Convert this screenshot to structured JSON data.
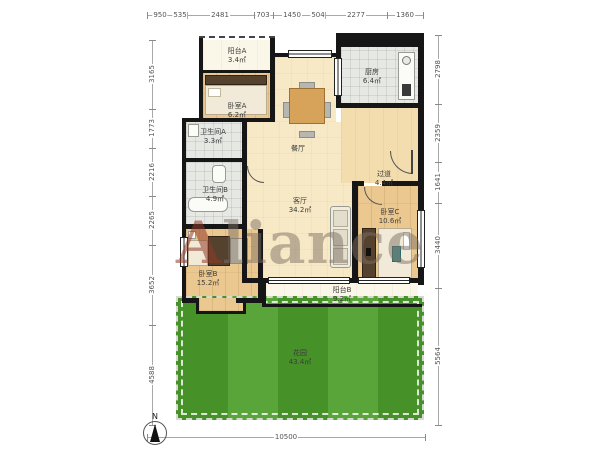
{
  "watermark": {
    "initial": "A",
    "rest": "liance"
  },
  "compass": {
    "north_label": "N"
  },
  "rooms": {
    "balcony_a": {
      "name": "阳台A",
      "area": "3.4㎡"
    },
    "bedroom_a": {
      "name": "卧室A",
      "area": "6.2㎡"
    },
    "bathroom_a": {
      "name": "卫生间A",
      "area": "3.3㎡"
    },
    "kitchen": {
      "name": "厨房",
      "area": "6.4㎡"
    },
    "dining": {
      "name": "餐厅"
    },
    "hallway": {
      "name": "过道",
      "area": "4.4㎡"
    },
    "living": {
      "name": "客厅",
      "area": "34.2㎡"
    },
    "bedroom_c": {
      "name": "卧室C",
      "area": "10.6㎡"
    },
    "bathroom_b": {
      "name": "卫生间B",
      "area": "4.9㎡"
    },
    "bedroom_b": {
      "name": "卧室B",
      "area": "15.2㎡"
    },
    "balcony_b": {
      "name": "阳台B",
      "area": "9.2㎡"
    },
    "garden": {
      "name": "花园",
      "area": "43.4㎡"
    }
  },
  "dimensions": {
    "top": [
      "950",
      "535",
      "2481",
      "703",
      "1450",
      "504",
      "2277",
      "1360"
    ],
    "left": [
      "3165",
      "1773",
      "2216",
      "2265",
      "3652",
      "4588"
    ],
    "right": [
      "2798",
      "2359",
      "1641",
      "3440",
      "5564"
    ],
    "bottom": [
      "10500"
    ]
  },
  "colors": {
    "wall": "#161616",
    "wood_floor": "#eac88f",
    "living_floor": "#f8e9c6",
    "tile_floor": "#e6e8e4",
    "balcony_floor": "#faf6e8",
    "garden": "#50a02f",
    "watermark": "#8b6a52"
  }
}
